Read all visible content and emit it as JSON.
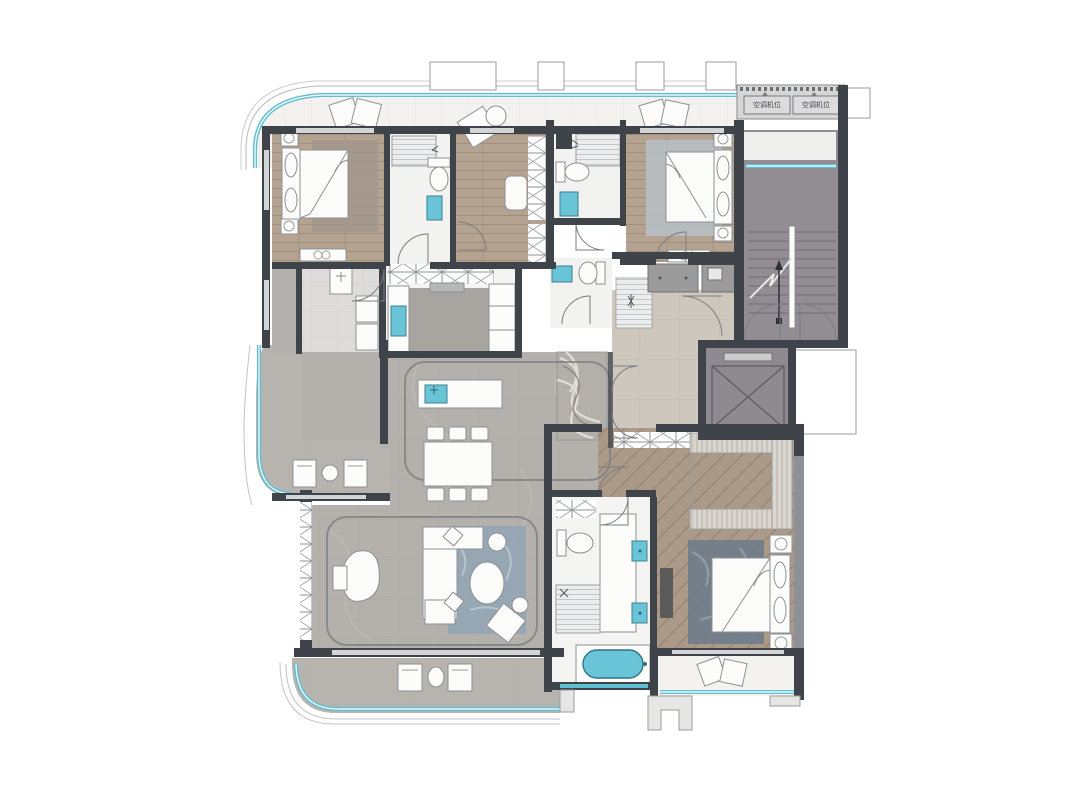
{
  "plan": {
    "ac_labels": [
      {
        "text": "空调机位"
      },
      {
        "text": "空调机位"
      }
    ]
  },
  "colors": {
    "wallDark": "#3f434a",
    "wallMid": "#8d9094",
    "wallLight": "#d2d4d5",
    "wood": "#b5a392",
    "woodLine": "#a08e7a",
    "herr": "#ab9a88",
    "herrLine": "#93826e",
    "marble": "#b4b0ab",
    "marbleBeige": "#cec7bd",
    "marbleWhite": "#f3f2ef",
    "tile": "#b7b3ae",
    "stair": "#928d93",
    "acGray": "#d6d6d6",
    "cyan": "#5fc0d3",
    "cyanLight": "#aadfe9",
    "rugBlue": "#92a6b4",
    "rugTan": "#a2988c",
    "rugSlate": "#707d89",
    "rugBlueLight": "#b7bfc3",
    "kitchenFloor": "#a8a4a0",
    "furnWhite": "#fcfcfb",
    "furnLine": "#8e9093",
    "tub": "#6ac4d8"
  }
}
